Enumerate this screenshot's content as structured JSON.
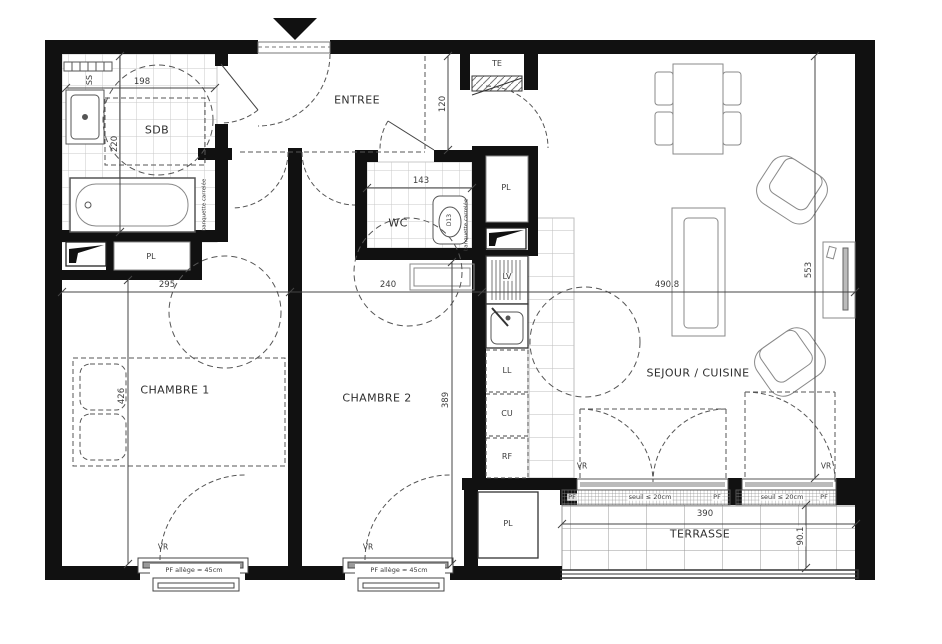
{
  "plan": {
    "rooms": {
      "entree": "ENTREE",
      "sdb": "SDB",
      "wc": "WC",
      "chambre1": "CHAMBRE 1",
      "chambre2": "CHAMBRE 2",
      "sejour": "SEJOUR / CUISINE",
      "terrasse": "TERRASSE"
    },
    "closets": {
      "pl": "PL"
    },
    "equipment": {
      "ss": "SS",
      "te": "TE",
      "lv": "LV",
      "ll": "LL",
      "cu": "CU",
      "rf": "RF",
      "toilet": "D13",
      "banquette": "banquette carrelée"
    },
    "windows": {
      "vr": "VR",
      "pf": "PF",
      "seuil": "seuil ≤ 20cm",
      "allege": "PF allège ≈ 45cm"
    },
    "dimensions": {
      "sdb_w": "198",
      "sdb_h": "220",
      "hall_w": "120",
      "wc_w": "143",
      "ch1_w": "295",
      "ch2_w": "240",
      "sejour_w": "490.8",
      "ch1_h": "426",
      "ch2_h": "389",
      "sejour_h": "553",
      "terrasse_w": "390",
      "terrasse_h": "90.1"
    },
    "colors": {
      "wall": "#111111",
      "line": "#555555",
      "tile": "#c9c9c9"
    }
  }
}
